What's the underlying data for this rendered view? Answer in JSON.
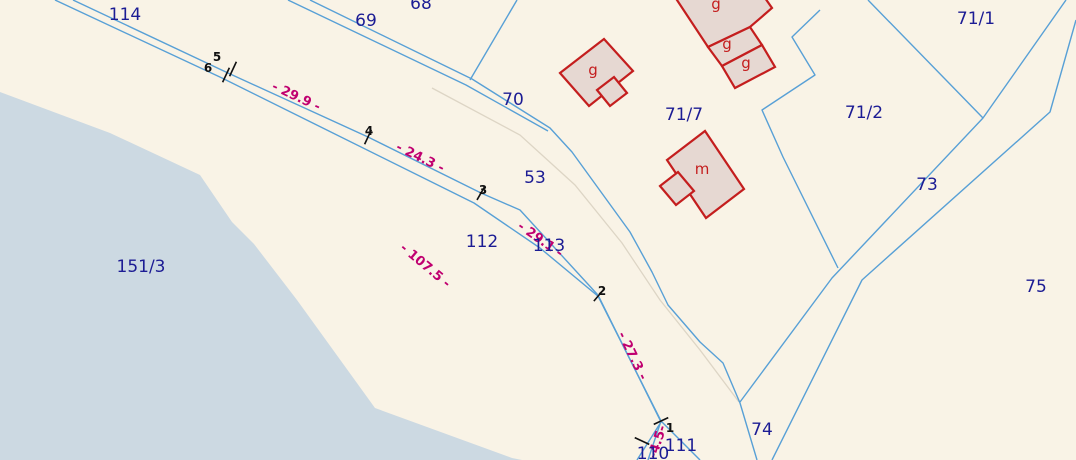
{
  "map": {
    "colors": {
      "background": "#f9f3e6",
      "boundary_line": "#58a0d6",
      "faint_path": "#ddd5c5",
      "parcel_label": "#1c1c94",
      "distance_label": "#c00070",
      "building_stroke": "#c41e1e",
      "building_fill": "#e6d8d2",
      "water_fill": "#ccd9e2",
      "survey_mark": "#111111"
    },
    "water": {
      "name": "water-body",
      "points": [
        [
          0,
          92
        ],
        [
          110,
          133
        ],
        [
          200,
          175
        ],
        [
          232,
          222
        ],
        [
          254,
          244
        ],
        [
          297,
          300
        ],
        [
          375,
          408
        ],
        [
          512,
          458
        ],
        [
          522,
          460
        ],
        [
          0,
          460
        ]
      ]
    },
    "faint_paths": [
      {
        "points": [
          [
            432,
            88
          ],
          [
            520,
            135
          ],
          [
            575,
            185
          ],
          [
            622,
            243
          ],
          [
            660,
            300
          ],
          [
            700,
            350
          ],
          [
            739,
            402
          ]
        ]
      }
    ],
    "boundaries": [
      {
        "name": "traverse-line-north",
        "points": [
          [
            73,
            0
          ],
          [
            228,
            73
          ],
          [
            368,
            137
          ],
          [
            481,
            193
          ],
          [
            520,
            210
          ],
          [
            597,
            294
          ],
          [
            661,
            421
          ],
          [
            648,
            460
          ]
        ]
      },
      {
        "name": "traverse-line-south",
        "points": [
          [
            55,
            0
          ],
          [
            222,
            78
          ],
          [
            474,
            203
          ],
          [
            540,
            248
          ],
          [
            599,
            297
          ],
          [
            661,
            422
          ],
          [
            637,
            460
          ]
        ]
      },
      {
        "name": "road-69-line-a",
        "points": [
          [
            310,
            0
          ],
          [
            472,
            79
          ],
          [
            550,
            128
          ],
          [
            572,
            152
          ],
          [
            601,
            192
          ],
          [
            630,
            232
          ],
          [
            652,
            272
          ],
          [
            668,
            305
          ],
          [
            700,
            342
          ],
          [
            723,
            363
          ],
          [
            740,
            403
          ],
          [
            757,
            460
          ]
        ]
      },
      {
        "name": "road-69-line-b",
        "points": [
          [
            288,
            0
          ],
          [
            466,
            85
          ],
          [
            548,
            131
          ]
        ]
      },
      {
        "name": "parcel-70-border",
        "points": [
          [
            517,
            0
          ],
          [
            470,
            80
          ]
        ]
      },
      {
        "name": "parcel-71-7-zigzag-border",
        "points": [
          [
            820,
            10
          ],
          [
            792,
            37
          ],
          [
            815,
            75
          ],
          [
            762,
            110
          ],
          [
            783,
            157
          ],
          [
            838,
            268
          ]
        ]
      },
      {
        "name": "road-73-line-left",
        "points": [
          [
            1066,
            0
          ],
          [
            983,
            118
          ],
          [
            832,
            278
          ],
          [
            740,
            402
          ]
        ]
      },
      {
        "name": "road-73-line-right",
        "points": [
          [
            1076,
            20
          ],
          [
            1050,
            112
          ],
          [
            862,
            280
          ],
          [
            772,
            460
          ]
        ]
      },
      {
        "name": "parcel-71-1-border",
        "points": [
          [
            868,
            0
          ],
          [
            983,
            118
          ]
        ]
      },
      {
        "name": "parcel-111-border",
        "points": [
          [
            661,
            421
          ],
          [
            700,
            460
          ]
        ]
      }
    ],
    "buildings": {
      "items": [
        {
          "label": "g",
          "label_xy": [
            716,
            4
          ],
          "points": [
            [
              673,
              -6
            ],
            [
              708,
              47
            ],
            [
              750,
              27
            ],
            [
              772,
              8
            ],
            [
              744,
              -32
            ],
            [
              690,
              -20
            ]
          ]
        },
        {
          "label": "g",
          "label_xy": [
            727,
            44
          ],
          "points": [
            [
              708,
              47
            ],
            [
              750,
              27
            ],
            [
              762,
              45
            ],
            [
              722,
              66
            ]
          ]
        },
        {
          "label": "g",
          "label_xy": [
            746,
            63
          ],
          "points": [
            [
              722,
              66
            ],
            [
              762,
              45
            ],
            [
              775,
              67
            ],
            [
              735,
              88
            ]
          ]
        },
        {
          "label": "g",
          "label_xy": [
            593,
            70
          ],
          "points": [
            [
              560,
              73
            ],
            [
              604,
              39
            ],
            [
              633,
              71
            ],
            [
              589,
              106
            ]
          ]
        },
        {
          "label": "",
          "label_xy": [
            0,
            0
          ],
          "points": [
            [
              597,
              90
            ],
            [
              614,
              77
            ],
            [
              627,
              93
            ],
            [
              610,
              106
            ]
          ]
        },
        {
          "label": "m",
          "label_xy": [
            702,
            169
          ],
          "points": [
            [
              667,
              160
            ],
            [
              705,
              131
            ],
            [
              744,
              189
            ],
            [
              706,
              218
            ]
          ]
        },
        {
          "label": "",
          "label_xy": [
            0,
            0
          ],
          "points": [
            [
              660,
              186
            ],
            [
              678,
              172
            ],
            [
              694,
              191
            ],
            [
              676,
              205
            ]
          ]
        }
      ]
    },
    "parcel_labels": [
      {
        "text": "114",
        "x": 125,
        "y": 15
      },
      {
        "text": "69",
        "x": 366,
        "y": 21
      },
      {
        "text": "68",
        "x": 421,
        "y": 4
      },
      {
        "text": "70",
        "x": 513,
        "y": 100
      },
      {
        "text": "71/1",
        "x": 976,
        "y": 19
      },
      {
        "text": "71/7",
        "x": 684,
        "y": 115
      },
      {
        "text": "71/2",
        "x": 864,
        "y": 113
      },
      {
        "text": "73",
        "x": 927,
        "y": 185
      },
      {
        "text": "53",
        "x": 535,
        "y": 178
      },
      {
        "text": "112",
        "x": 482,
        "y": 242
      },
      {
        "text": "113",
        "x": 549,
        "y": 246
      },
      {
        "text": "151/3",
        "x": 141,
        "y": 267
      },
      {
        "text": "75",
        "x": 1036,
        "y": 287
      },
      {
        "text": "74",
        "x": 762,
        "y": 430
      },
      {
        "text": "111",
        "x": 681,
        "y": 446
      },
      {
        "text": "110",
        "x": 653,
        "y": 454
      }
    ],
    "distance_labels": [
      {
        "text": "- 29.9 -",
        "x": 296,
        "y": 97,
        "rot": 25
      },
      {
        "text": "- 24.3 -",
        "x": 420,
        "y": 158,
        "rot": 26
      },
      {
        "text": "- 29.1 -",
        "x": 540,
        "y": 240,
        "rot": 35
      },
      {
        "text": "- 107.5 -",
        "x": 425,
        "y": 266,
        "rot": 40
      },
      {
        "text": "- 27.3 -",
        "x": 632,
        "y": 356,
        "rot": 64
      },
      {
        "text": "-4.5-",
        "x": 658,
        "y": 442,
        "rot": -72
      }
    ],
    "survey_points": {
      "labels": [
        {
          "text": "5",
          "x": 217,
          "y": 57
        },
        {
          "text": "6",
          "x": 208,
          "y": 68
        },
        {
          "text": "4",
          "x": 369,
          "y": 131
        },
        {
          "text": "3",
          "x": 483,
          "y": 190
        },
        {
          "text": "2",
          "x": 602,
          "y": 291
        },
        {
          "text": "1",
          "x": 670,
          "y": 428
        }
      ],
      "ticks": [
        {
          "x": 226,
          "y": 75,
          "a": -65
        },
        {
          "x": 233,
          "y": 69,
          "a": -65
        },
        {
          "x": 368,
          "y": 137,
          "a": -65
        },
        {
          "x": 481,
          "y": 193,
          "a": -60
        },
        {
          "x": 599,
          "y": 295,
          "a": -50
        },
        {
          "x": 661,
          "y": 421,
          "a": -25
        },
        {
          "x": 642,
          "y": 441,
          "a": 25
        }
      ]
    }
  }
}
